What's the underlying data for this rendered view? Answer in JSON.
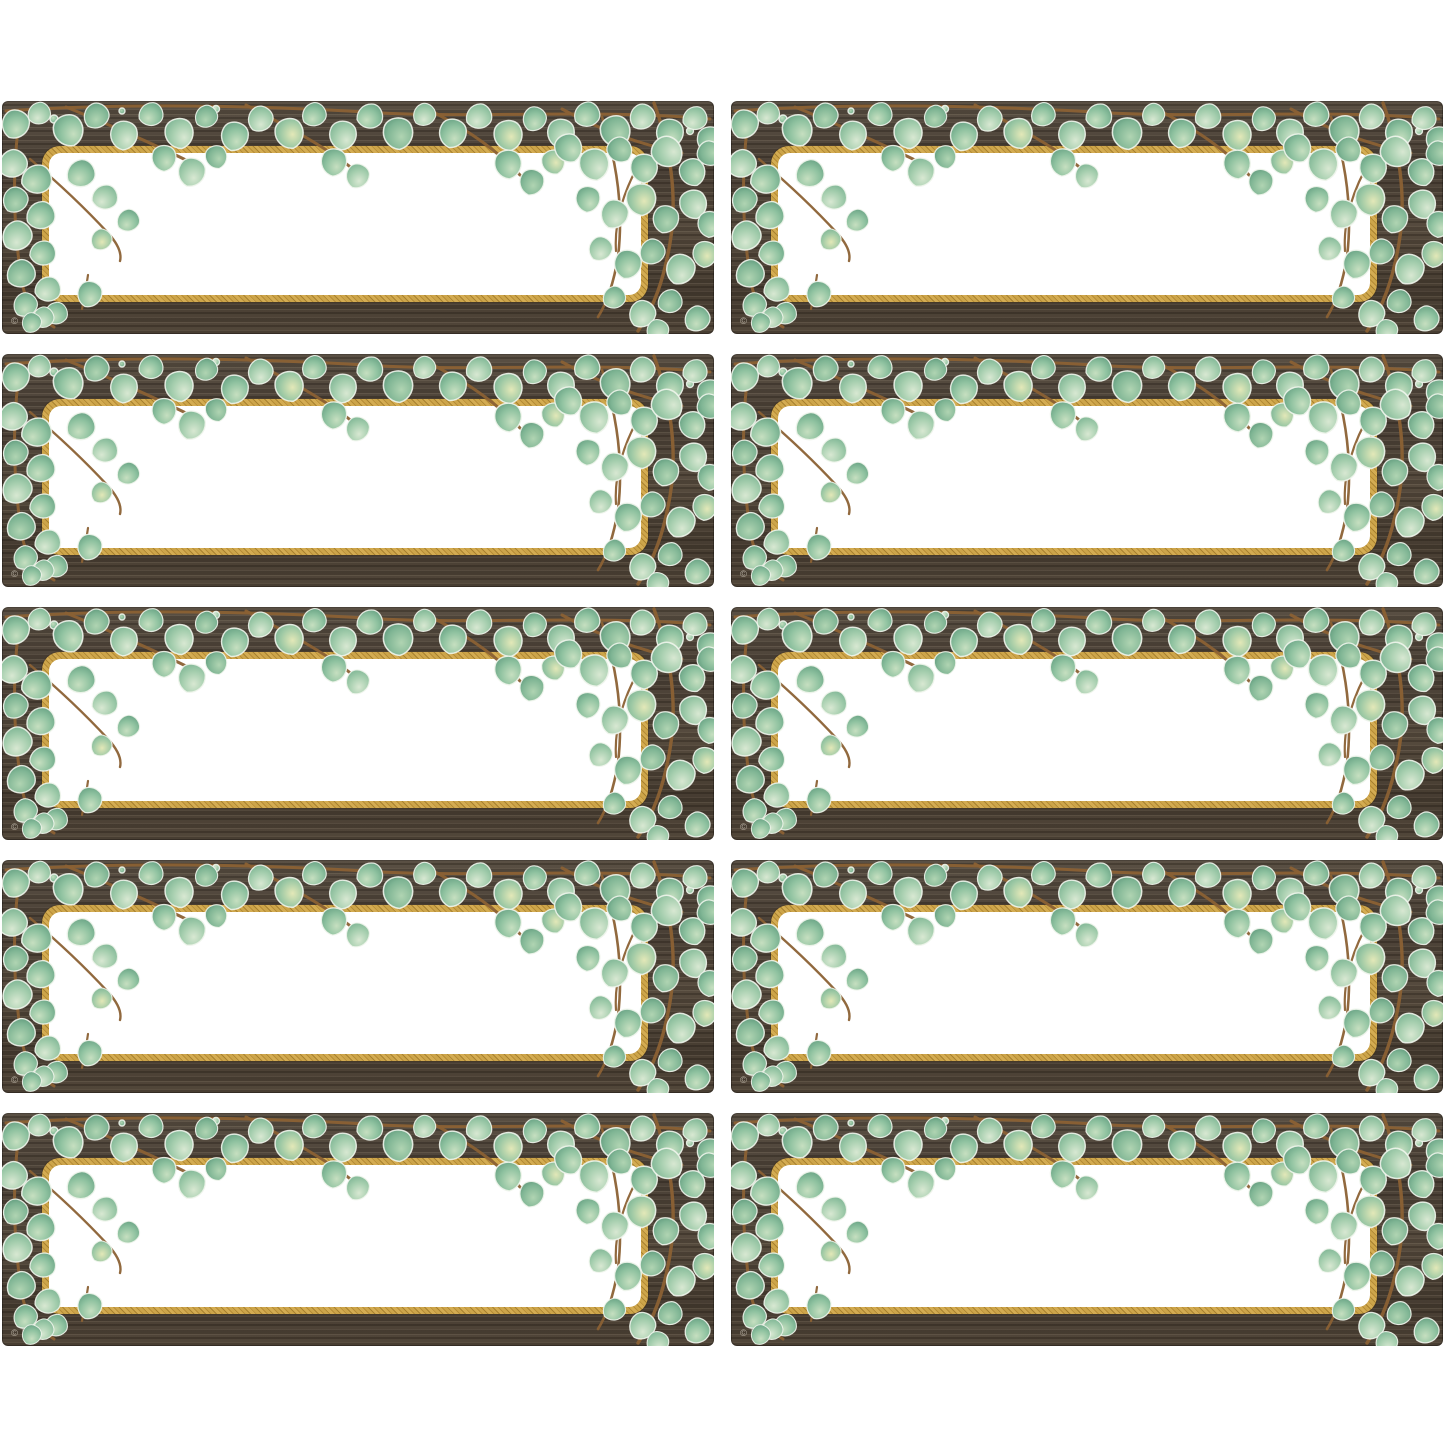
{
  "page": {
    "background_color": "#ffffff"
  },
  "grid": {
    "rows": 5,
    "columns": 2,
    "card_count": 10
  },
  "card": {
    "copyright_mark": "© TCR",
    "label_text": ""
  },
  "cards": [
    {
      "label_text": ""
    },
    {
      "label_text": ""
    },
    {
      "label_text": ""
    },
    {
      "label_text": ""
    },
    {
      "label_text": ""
    },
    {
      "label_text": ""
    },
    {
      "label_text": ""
    },
    {
      "label_text": ""
    },
    {
      "label_text": ""
    },
    {
      "label_text": ""
    }
  ],
  "colors": {
    "page_background": "#ffffff",
    "wood_dark": "#4a4036",
    "wood_mid": "#554a3d",
    "wood_light_grain": "#6e6152",
    "gold_border": "#c49c44",
    "gold_border_dark": "#a8812f",
    "panel_white": "#ffffff",
    "leaf_light": "#d8e8d2",
    "leaf_mid": "#8fc2a0",
    "leaf_dark": "#649f81",
    "leaf_highlight": "#e3e8b8",
    "branch_brown": "#8b6134",
    "copyright_text": "#c9c2b5"
  }
}
